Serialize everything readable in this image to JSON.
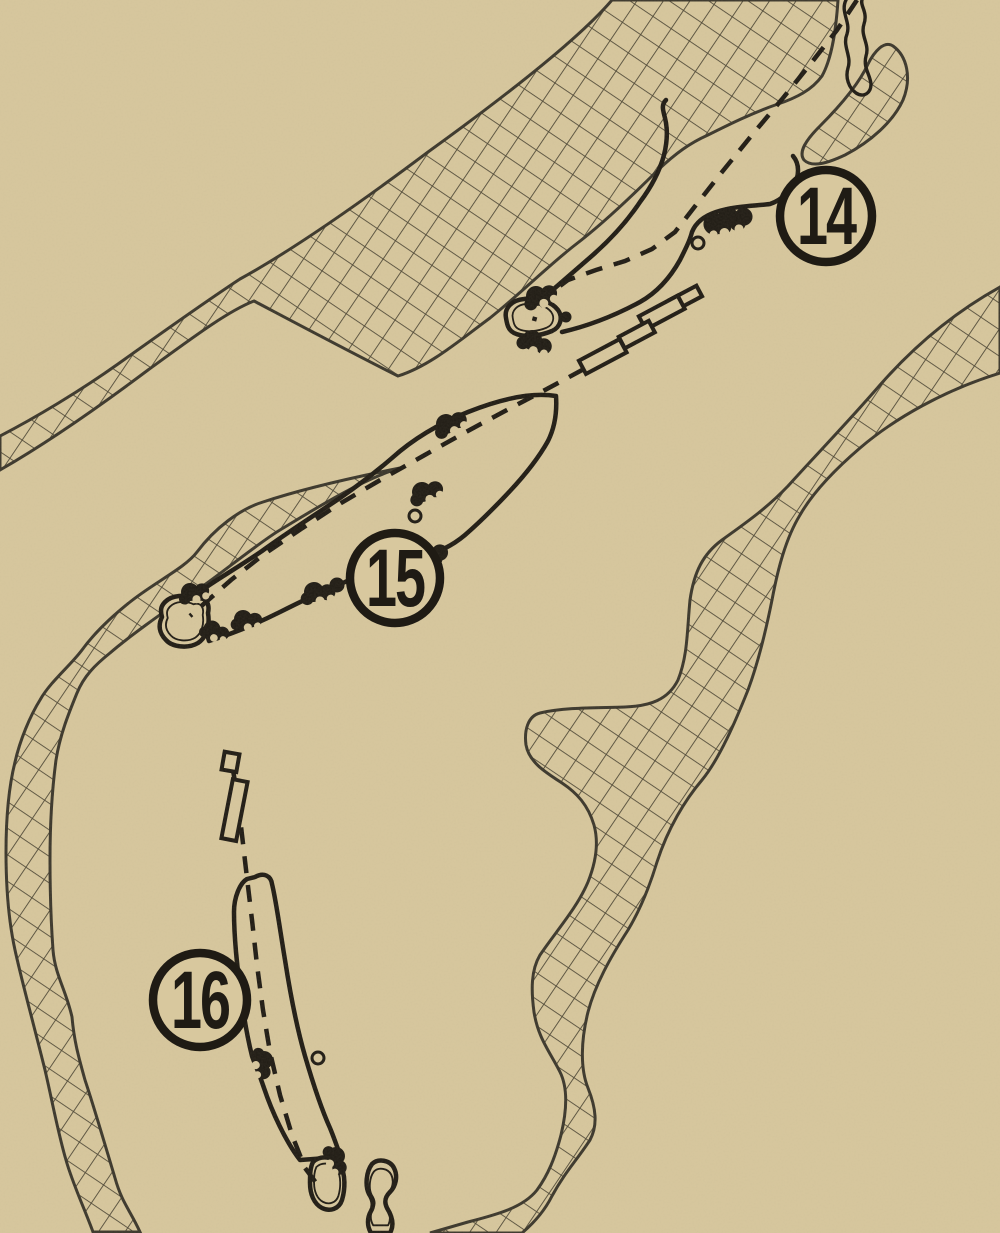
{
  "artwork": {
    "type": "golf-course-hole-layout-print",
    "style": "vintage line art on kraft paper"
  },
  "holes": [
    {
      "number": "14",
      "marker": {
        "x": 826,
        "y": 216,
        "r": 46
      }
    },
    {
      "number": "15",
      "marker": {
        "x": 395,
        "y": 578,
        "r": 45
      }
    },
    {
      "number": "16",
      "marker": {
        "x": 200,
        "y": 1000,
        "r": 47
      }
    }
  ],
  "features": {
    "hazard_fill": "cross-hatch",
    "green_outline": "double line",
    "centerline_style": "dashed",
    "bunker_style": "solid black blobs",
    "tee_style": "outlined rectangles",
    "creek_icon": "wavy band"
  },
  "colors": {
    "paper": "#d8c89e",
    "ink": "#1f1b14",
    "hatch_line": "#4e4836",
    "region_line": "#3b372c",
    "grain_tint": "#6b5c42"
  }
}
